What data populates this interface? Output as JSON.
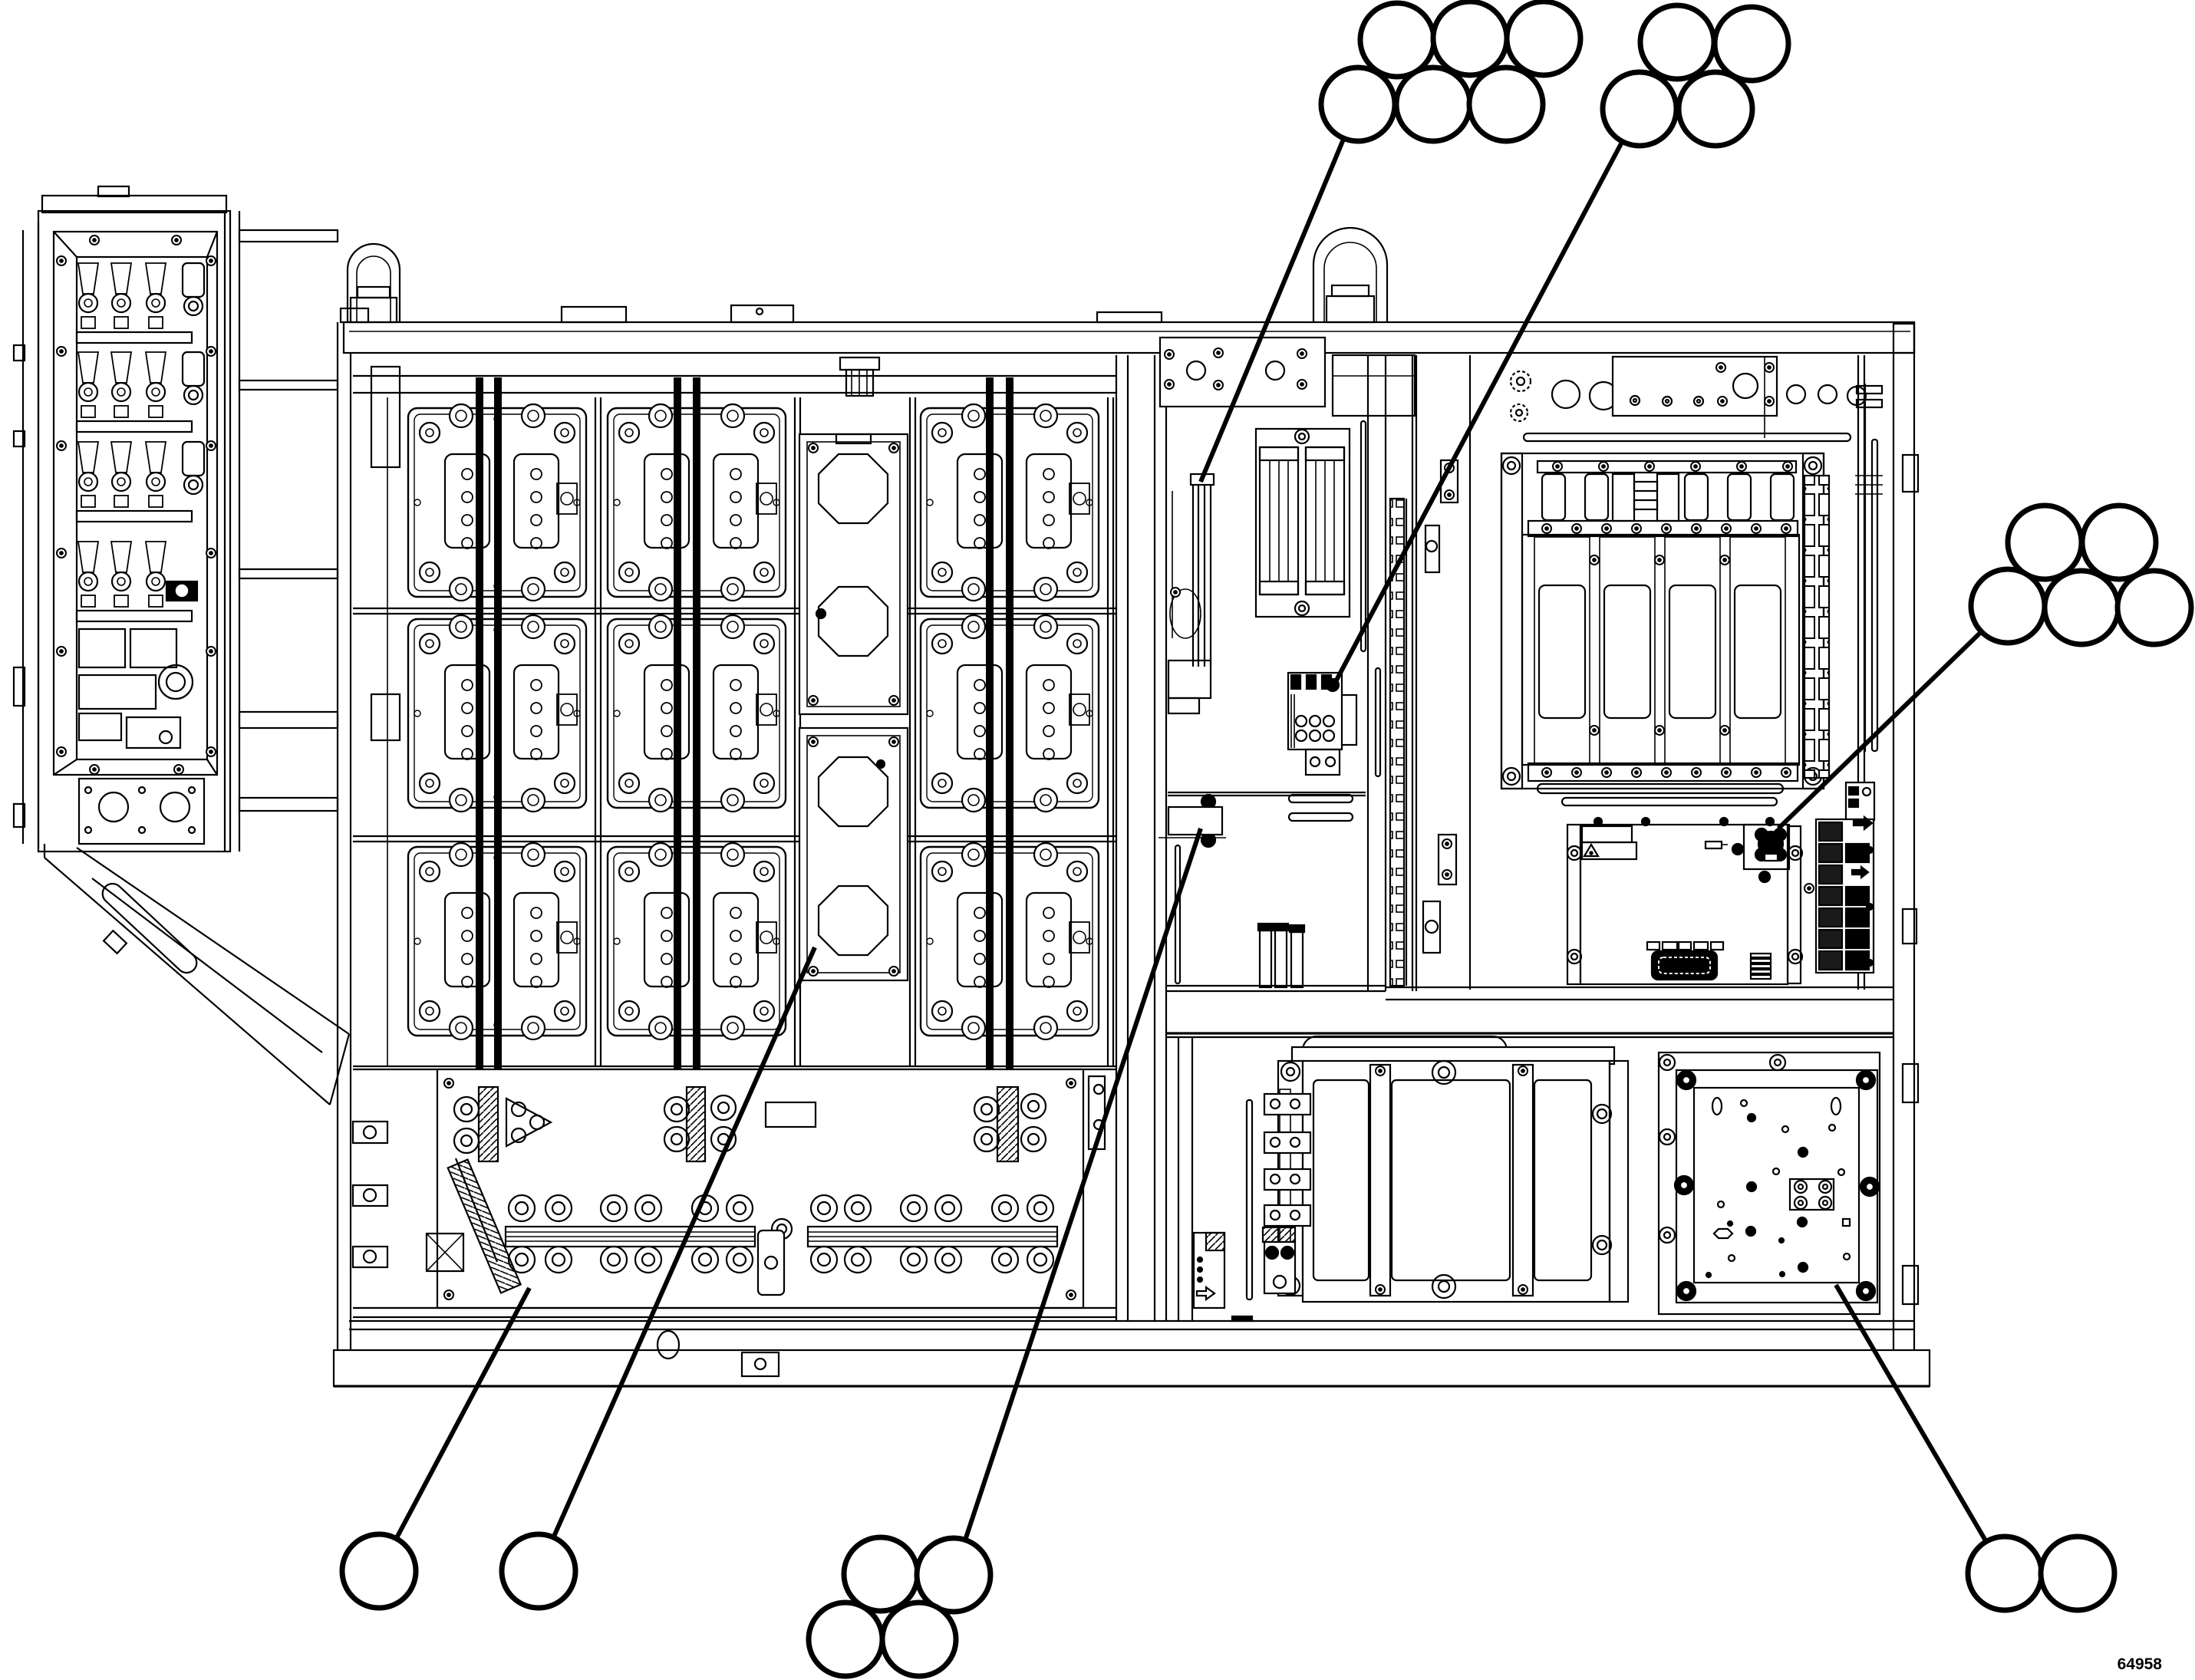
{
  "figure": {
    "type": "parts-callout-diagram",
    "subject": "industrial power cabinet internal front view line drawing",
    "drawing_number": "64958",
    "line_color": "#000000",
    "background_color": "#ffffff"
  },
  "callouts": {
    "balloon_radius": 48,
    "balloon_stroke_width": 7,
    "balloon_fill": "#ffffff",
    "leader_stroke_width": 6,
    "groups": [
      {
        "id": "group-1",
        "target": "sensor-bracket-center-bay-top",
        "balloons": [
          [
            1821,
            52
          ],
          [
            1916,
            50
          ],
          [
            2012,
            50
          ],
          [
            1770,
            136
          ],
          [
            1868,
            136
          ],
          [
            1963,
            136
          ]
        ],
        "leader": {
          "from": [
            1770,
            136
          ],
          "to": [
            1565,
            628
          ]
        }
      },
      {
        "id": "group-2",
        "target": "contactor-block-center-bay",
        "balloons": [
          [
            2186,
            55
          ],
          [
            2283,
            57
          ],
          [
            2137,
            142
          ],
          [
            2236,
            142
          ]
        ],
        "leader": {
          "from": [
            2137,
            142
          ],
          "to": [
            1737,
            896
          ]
        }
      },
      {
        "id": "group-3",
        "target": "control-board-relay",
        "balloons": [
          [
            2665,
            707
          ],
          [
            2762,
            707
          ],
          [
            2617,
            790
          ],
          [
            2713,
            792
          ],
          [
            2808,
            792
          ]
        ],
        "leader": {
          "from": [
            2617,
            790
          ],
          "to": [
            2318,
            1080
          ]
        }
      },
      {
        "id": "group-4",
        "target": "diagonal-busbar-guard",
        "balloons": [
          [
            494,
            2048
          ]
        ],
        "leader": {
          "from": [
            494,
            2048
          ],
          "to": [
            690,
            1679
          ]
        }
      },
      {
        "id": "group-5",
        "target": "lower-heatsink-panel",
        "balloons": [
          [
            702,
            2048
          ]
        ],
        "leader": {
          "from": [
            702,
            2048
          ],
          "to": [
            1062,
            1235
          ]
        }
      },
      {
        "id": "group-6",
        "target": "center-bay-lower-bracket",
        "balloons": [
          [
            1148,
            2052
          ],
          [
            1243,
            2053
          ],
          [
            1102,
            2137
          ],
          [
            1198,
            2137
          ]
        ],
        "leader": {
          "from": [
            1243,
            2053
          ],
          "to": [
            1565,
            1080
          ]
        }
      },
      {
        "id": "group-7",
        "target": "blank-mounting-panel",
        "balloons": [
          [
            2613,
            2051
          ],
          [
            2708,
            2051
          ]
        ],
        "leader": {
          "from": [
            2613,
            2051
          ],
          "to": [
            2393,
            1675
          ]
        }
      }
    ]
  }
}
